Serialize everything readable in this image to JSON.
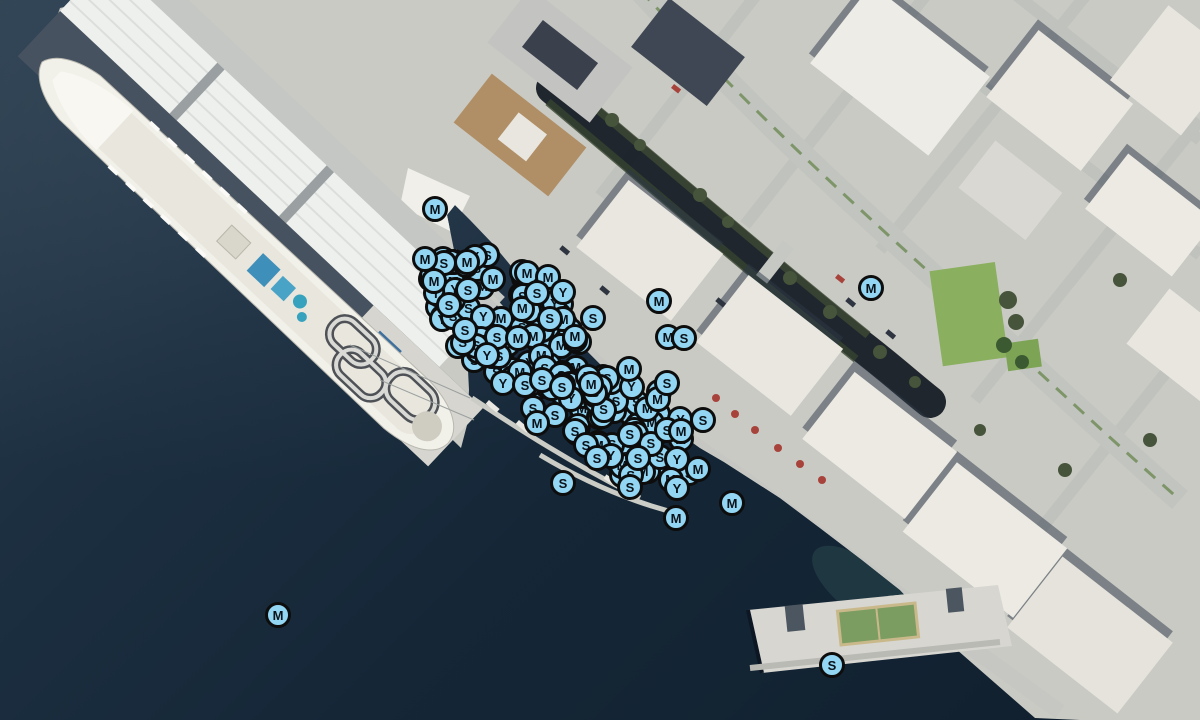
{
  "map": {
    "description": "Aerial satellite view of a waterfront: cruise ship berthed at a warehouse pier, marina basin densely clustered with circular moorage markers, city street grid and buildings upper right, small pier with sport court lower right",
    "marker_letters": [
      "M",
      "S",
      "Y"
    ],
    "marker_style": {
      "fill": "#92d6f3",
      "ring": "#0d0d0d",
      "letter_color": "#0a1118",
      "diameter_px": 26
    },
    "colors": {
      "water_deep": "#101f2e",
      "water_light": "#2c3f50",
      "land": "#c9cac4",
      "roofs": "#eceae3",
      "park_green": "#8aaf5e",
      "tree_green": "#46543b",
      "canal_shadow": "#11181f"
    },
    "cluster_fills": [
      {
        "name": "marina-north-cluster",
        "cx": 506,
        "cy": 320,
        "radius_major": 90,
        "radius_minor": 52,
        "angle_deg": 40,
        "count": 95,
        "letter_weights": {
          "S": 0.42,
          "M": 0.33,
          "Y": 0.25
        }
      },
      {
        "name": "marina-south-cluster",
        "cx": 633,
        "cy": 430,
        "radius_major": 74,
        "radius_minor": 46,
        "angle_deg": 40,
        "count": 72,
        "letter_weights": {
          "S": 0.55,
          "M": 0.3,
          "Y": 0.15
        }
      },
      {
        "name": "marina-mid-cluster",
        "cx": 572,
        "cy": 378,
        "radius_major": 34,
        "radius_minor": 24,
        "angle_deg": 40,
        "count": 14,
        "letter_weights": {
          "S": 0.5,
          "M": 0.3,
          "Y": 0.2
        }
      }
    ],
    "labeled_markers": [
      {
        "x": 435,
        "y": 209,
        "letter": "M"
      },
      {
        "x": 871,
        "y": 288,
        "letter": "M"
      },
      {
        "x": 659,
        "y": 301,
        "letter": "M"
      },
      {
        "x": 668,
        "y": 337,
        "letter": "M"
      },
      {
        "x": 684,
        "y": 338,
        "letter": "S"
      },
      {
        "x": 563,
        "y": 483,
        "letter": "S"
      },
      {
        "x": 732,
        "y": 503,
        "letter": "M"
      },
      {
        "x": 676,
        "y": 518,
        "letter": "M"
      },
      {
        "x": 278,
        "y": 615,
        "letter": "M"
      },
      {
        "x": 832,
        "y": 665,
        "letter": "S"
      },
      {
        "x": 425,
        "y": 259,
        "letter": "M"
      },
      {
        "x": 467,
        "y": 262,
        "letter": "M"
      },
      {
        "x": 434,
        "y": 281,
        "letter": "M"
      },
      {
        "x": 468,
        "y": 290,
        "letter": "S"
      },
      {
        "x": 493,
        "y": 279,
        "letter": "M"
      },
      {
        "x": 527,
        "y": 273,
        "letter": "M"
      },
      {
        "x": 548,
        "y": 277,
        "letter": "M"
      },
      {
        "x": 537,
        "y": 293,
        "letter": "S"
      },
      {
        "x": 563,
        "y": 292,
        "letter": "Y"
      },
      {
        "x": 449,
        "y": 305,
        "letter": "S"
      },
      {
        "x": 593,
        "y": 318,
        "letter": "S"
      },
      {
        "x": 465,
        "y": 330,
        "letter": "S"
      },
      {
        "x": 497,
        "y": 337,
        "letter": "S"
      },
      {
        "x": 518,
        "y": 338,
        "letter": "M"
      },
      {
        "x": 487,
        "y": 355,
        "letter": "Y"
      },
      {
        "x": 503,
        "y": 383,
        "letter": "Y"
      },
      {
        "x": 525,
        "y": 385,
        "letter": "S"
      },
      {
        "x": 542,
        "y": 380,
        "letter": "S"
      },
      {
        "x": 562,
        "y": 387,
        "letter": "S"
      },
      {
        "x": 533,
        "y": 408,
        "letter": "S"
      },
      {
        "x": 555,
        "y": 415,
        "letter": "S"
      },
      {
        "x": 537,
        "y": 423,
        "letter": "M"
      },
      {
        "x": 577,
        "y": 433,
        "letter": "S"
      },
      {
        "x": 629,
        "y": 369,
        "letter": "M"
      },
      {
        "x": 667,
        "y": 383,
        "letter": "S"
      },
      {
        "x": 703,
        "y": 420,
        "letter": "S"
      },
      {
        "x": 667,
        "y": 430,
        "letter": "S"
      },
      {
        "x": 681,
        "y": 431,
        "letter": "M"
      },
      {
        "x": 575,
        "y": 431,
        "letter": "S"
      },
      {
        "x": 586,
        "y": 445,
        "letter": "S"
      },
      {
        "x": 597,
        "y": 458,
        "letter": "S"
      },
      {
        "x": 638,
        "y": 458,
        "letter": "S"
      },
      {
        "x": 630,
        "y": 487,
        "letter": "S"
      },
      {
        "x": 677,
        "y": 488,
        "letter": "Y"
      },
      {
        "x": 698,
        "y": 469,
        "letter": "M"
      }
    ]
  }
}
